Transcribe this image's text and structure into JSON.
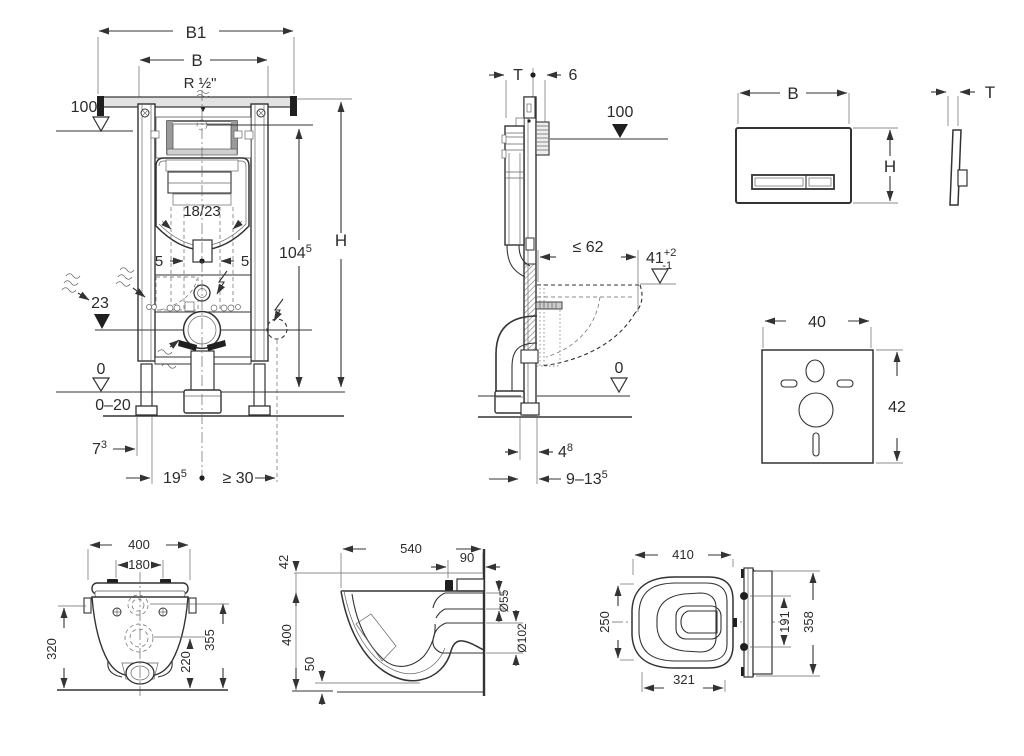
{
  "colors": {
    "line": "#333333",
    "light_fill": "#e2e2e2",
    "dark_fill": "#1f1f1f",
    "background": "#ffffff"
  },
  "frame_front": {
    "b1": "B1",
    "b": "B",
    "water_conn": "R ½\"",
    "level_top": "100",
    "bolt_spacing": "18/23",
    "bolt_left": "5",
    "bolt_right": "5",
    "h104_main": "104",
    "h104_sup": "5",
    "height": "H",
    "outlet_level": "23",
    "floor_zero": "0",
    "floor_range": "0–20",
    "d7_main": "7",
    "d7_sup": "3",
    "d19_main": "19",
    "d19_sup": "5",
    "d30": "≥ 30"
  },
  "frame_side": {
    "depth": "T",
    "offset6": "6",
    "level": "100",
    "le62": "≤ 62",
    "d41_main": "41",
    "d41_sup": "+2",
    "d41_sub": "-1",
    "floor_zero": "0",
    "d4_main": "4",
    "d4_sup": "8",
    "d913_main": "9–13",
    "d913_sup": "5"
  },
  "flush_plate": {
    "width": "B",
    "height": "H",
    "thickness": "T"
  },
  "sound_pad": {
    "width": "40",
    "height": "42"
  },
  "wc_back": {
    "width": "400",
    "bolt_width": "180",
    "h_left": "320",
    "h_outlet": "220",
    "h_right": "355"
  },
  "wc_side": {
    "length": "540",
    "d90": "90",
    "d42": "42",
    "height": "400",
    "d50": "50",
    "flush_dia": "Ø55",
    "outlet_dia": "Ø102"
  },
  "wc_top": {
    "length": "410",
    "width_front": "250",
    "bolt_spacing": "191",
    "width_wall": "358",
    "length_bowl": "321"
  }
}
